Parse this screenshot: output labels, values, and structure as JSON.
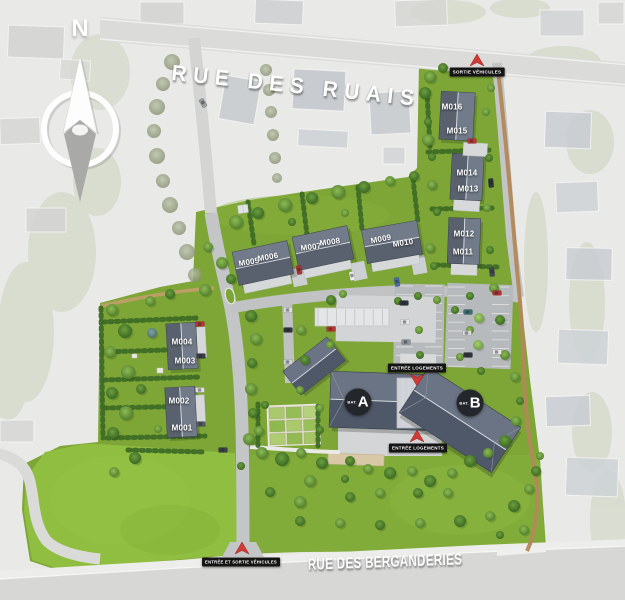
{
  "site_plan": {
    "compass": {
      "north": "N"
    },
    "streets": {
      "top": "RUE DES RUAIS",
      "bottom": "RUE DES BERGANDERIES"
    },
    "markers": {
      "vehicle_exit": "SORTIE VÉHICULES",
      "homes_entrance_north": "ENTRÉE LOGEMENTS",
      "homes_entrance_south": "ENTRÉE LOGEMENTS",
      "vehicle_entrance_exit": "ENTRÉE ET SORTIE VÉHICULES"
    },
    "buildings": {
      "a": {
        "prefix": "BAT.",
        "label": "A"
      },
      "b": {
        "prefix": "BAT.",
        "label": "B"
      }
    },
    "plots": [
      {
        "id": "M001"
      },
      {
        "id": "M002"
      },
      {
        "id": "M003"
      },
      {
        "id": "M004"
      },
      {
        "id": "M005"
      },
      {
        "id": "M006"
      },
      {
        "id": "M007"
      },
      {
        "id": "M008"
      },
      {
        "id": "M009"
      },
      {
        "id": "M010"
      },
      {
        "id": "M011"
      },
      {
        "id": "M012"
      },
      {
        "id": "M013"
      },
      {
        "id": "M014"
      },
      {
        "id": "M015"
      },
      {
        "id": "M016"
      }
    ],
    "colors": {
      "lawn": "#7da636",
      "field": "#8fbe41",
      "roof": "#4f5868",
      "road": "#c3c5c7",
      "marker_bg": "#141414",
      "arrow_red": "#d33a35"
    }
  }
}
